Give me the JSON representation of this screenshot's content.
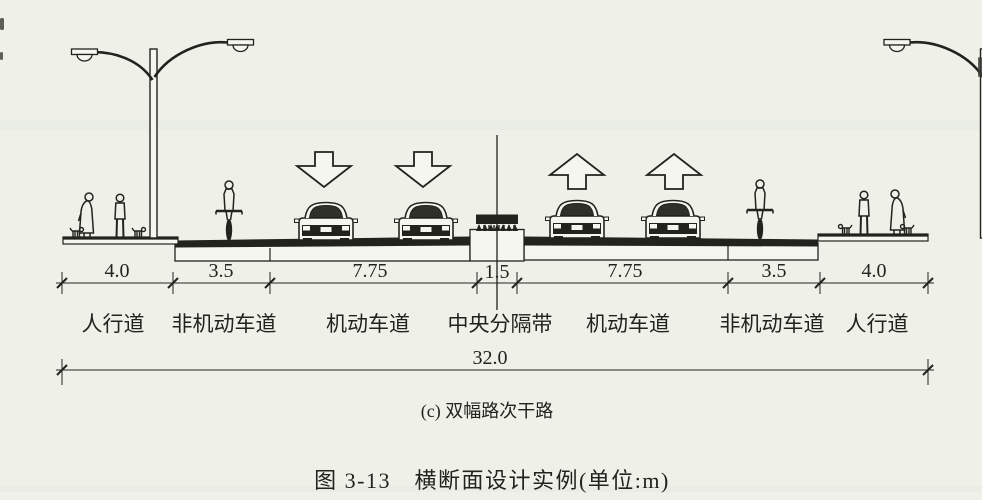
{
  "figure": {
    "panel_caption": "(c) 双幅路次干路",
    "title": "图 3-13　横断面设计实例(单位:m)",
    "unit": "m"
  },
  "dimensions": {
    "total": "32.0",
    "segments": [
      {
        "label": "人行道",
        "width": "4.0"
      },
      {
        "label": "非机动车道",
        "width": "3.5"
      },
      {
        "label": "机动车道",
        "width": "7.75"
      },
      {
        "label": "中央分隔带",
        "width": "1.5"
      },
      {
        "label": "机动车道",
        "width": "7.75"
      },
      {
        "label": "非机动车道",
        "width": "3.5"
      },
      {
        "label": "人行道",
        "width": "4.0"
      }
    ]
  },
  "colors": {
    "paper": "#eff0e8",
    "ink": "#23231e",
    "fill_white": "#f5f6ef"
  }
}
